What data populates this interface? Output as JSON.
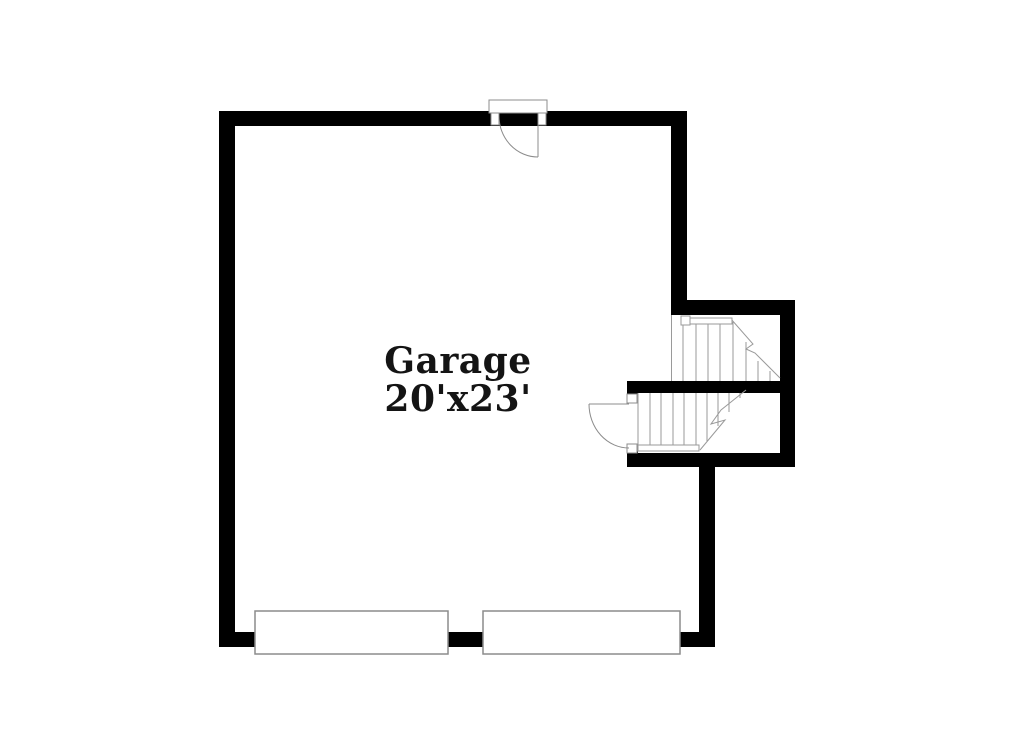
{
  "floorplan": {
    "room_label": {
      "name": "Garage",
      "dimensions": "20'x23'"
    },
    "colors": {
      "background": "#ffffff",
      "wall": "#000000",
      "thin_line": "#9a9a9a",
      "door_line": "#8c8c8c",
      "fill": "#ffffff",
      "text": "#141414"
    },
    "walls": [
      {
        "name": "top-wall",
        "x": 219,
        "y": 111,
        "w": 468,
        "h": 15
      },
      {
        "name": "left-wall",
        "x": 219,
        "y": 111,
        "w": 16,
        "h": 536
      },
      {
        "name": "bottom-wall",
        "x": 219,
        "y": 632,
        "w": 496,
        "h": 15
      },
      {
        "name": "garage-right-wall",
        "x": 671,
        "y": 111,
        "w": 16,
        "h": 204
      },
      {
        "name": "stair-top-wall",
        "x": 671,
        "y": 300,
        "w": 124,
        "h": 15
      },
      {
        "name": "stair-right-wall",
        "x": 780,
        "y": 300,
        "w": 15,
        "h": 167
      },
      {
        "name": "stair-middle-wall",
        "x": 627,
        "y": 381,
        "w": 168,
        "h": 12
      },
      {
        "name": "stair-bottom-wall",
        "x": 627,
        "y": 453,
        "w": 168,
        "h": 14
      },
      {
        "name": "stair-door-wall-top",
        "x": 627,
        "y": 381,
        "w": 11,
        "h": 13
      },
      {
        "name": "stair-door-wall-bottom",
        "x": 627,
        "y": 444,
        "w": 11,
        "h": 23
      },
      {
        "name": "garage-lower-right-wall",
        "x": 699,
        "y": 453,
        "w": 16,
        "h": 194
      }
    ],
    "stairs": {
      "edge_lines": [
        {
          "name": "upper-stairwell-edge-line",
          "x1": 671.5,
          "y1": 315,
          "x2": 671.5,
          "y2": 381
        }
      ],
      "treads_upper": [
        [
          683,
          322,
          381
        ],
        [
          696,
          322,
          381
        ],
        [
          708,
          322,
          381
        ],
        [
          720,
          322,
          381
        ],
        [
          733,
          322,
          381
        ],
        [
          746,
          342,
          381
        ],
        [
          758,
          361,
          381
        ],
        [
          770,
          371,
          381
        ]
      ],
      "treads_lower": [
        [
          638,
          393,
          450
        ],
        [
          650,
          393,
          450
        ],
        [
          661,
          393,
          450
        ],
        [
          673,
          393,
          450
        ],
        [
          684,
          393,
          450
        ],
        [
          696,
          393,
          450
        ],
        [
          707,
          393,
          441
        ],
        [
          718,
          393,
          426
        ],
        [
          729,
          393,
          412
        ],
        [
          740,
          393,
          398
        ]
      ],
      "rails": [
        {
          "name": "upper-stairs-newel",
          "x": 681,
          "y": 316,
          "w": 9,
          "h": 9
        },
        {
          "name": "upper-stairs-rail",
          "x": 690,
          "y": 318,
          "w": 42,
          "h": 6
        },
        {
          "name": "lower-stairs-rail",
          "x": 638,
          "y": 445,
          "w": 61,
          "h": 6
        }
      ],
      "break_lines": [
        {
          "name": "upper-stairs-break-line",
          "points": "731,319 753,344 746,349 755,353 780,378"
        },
        {
          "name": "lower-stairs-break-line",
          "points": "700,450 725,420 711,424 721,410 746,390"
        }
      ]
    },
    "door_frames": [
      {
        "name": "top-door-header",
        "x": 489,
        "y": 100,
        "w": 58,
        "h": 13
      },
      {
        "name": "top-door-jamb-left",
        "x": 491,
        "y": 113,
        "w": 8,
        "h": 12
      },
      {
        "name": "top-door-jamb-right",
        "x": 538,
        "y": 113,
        "w": 8,
        "h": 12
      },
      {
        "name": "stair-door-jamb-top",
        "x": 627,
        "y": 394,
        "w": 10,
        "h": 9
      },
      {
        "name": "stair-door-jamb-bottom",
        "x": 627,
        "y": 444,
        "w": 10,
        "h": 9
      }
    ],
    "door_leaves": [
      {
        "name": "top-door-leaf",
        "x1": 538,
        "y1": 116,
        "x2": 538,
        "y2": 157
      },
      {
        "name": "stair-door-leaf",
        "x1": 589,
        "y1": 404,
        "x2": 629,
        "y2": 404
      }
    ],
    "door_arcs": [
      {
        "name": "top-door-swing-arc",
        "d": "M 499 116 A 39 41 0 0 0 538 157"
      },
      {
        "name": "stair-door-swing-arc",
        "d": "M 589 404 A 40 44 0 0 0 629 448"
      }
    ],
    "garage_doors": [
      {
        "name": "garage-door-panel-1",
        "x": 255,
        "y": 611,
        "w": 193,
        "h": 43
      },
      {
        "name": "garage-door-panel-2",
        "x": 483,
        "y": 611,
        "w": 197,
        "h": 43
      }
    ]
  }
}
